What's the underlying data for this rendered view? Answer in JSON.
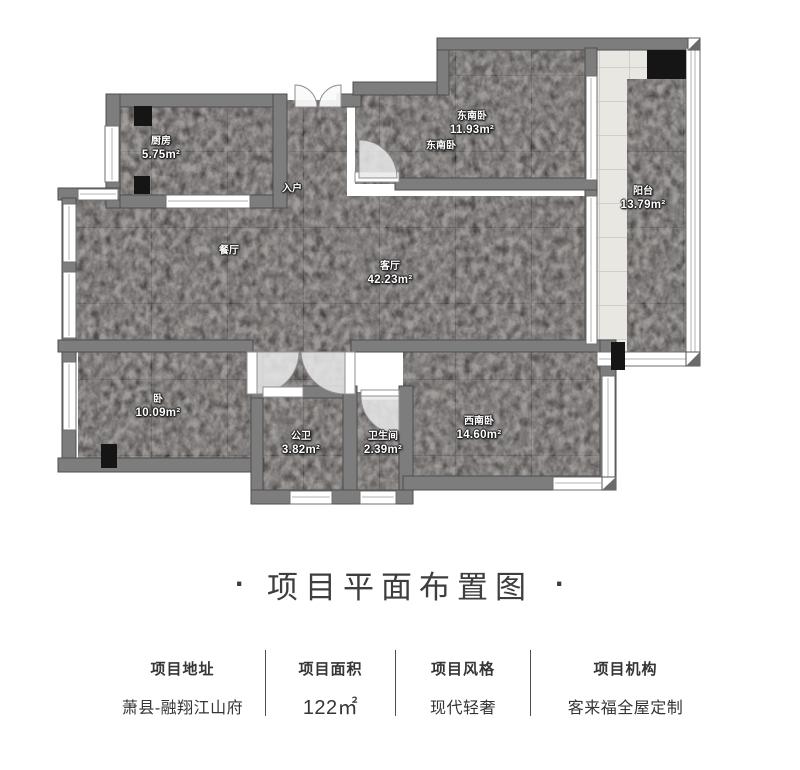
{
  "plan": {
    "rooms": [
      {
        "id": "kitchen",
        "name": "厨房",
        "area": "5.75m²"
      },
      {
        "id": "entry",
        "name": "入户",
        "area": ""
      },
      {
        "id": "southeast-bedroom",
        "name": "东南卧",
        "area": "11.93m²"
      },
      {
        "id": "southeast-bedroom-2",
        "name": "东南卧",
        "area": ""
      },
      {
        "id": "balcony",
        "name": "阳台",
        "area": "13.79m²"
      },
      {
        "id": "dining",
        "name": "餐厅",
        "area": ""
      },
      {
        "id": "living",
        "name": "客厅",
        "area": "42.23m²"
      },
      {
        "id": "bedroom",
        "name": "卧",
        "area": "10.09m²"
      },
      {
        "id": "public-bath",
        "name": "公卫",
        "area": "3.82m²"
      },
      {
        "id": "bathroom",
        "name": "卫生间",
        "area": "2.39m²"
      },
      {
        "id": "southwest-bedroom",
        "name": "西南卧",
        "area": "14.60m²"
      }
    ]
  },
  "title": {
    "dot": "·",
    "text": "项目平面布置图"
  },
  "info": [
    {
      "label": "项目地址",
      "value": "萧县-融翔江山府"
    },
    {
      "label": "项目面积",
      "value": "122㎡"
    },
    {
      "label": "项目风格",
      "value": "现代轻奢"
    },
    {
      "label": "项目机构",
      "value": "客来福全屋定制"
    }
  ],
  "colors": {
    "wall": "#7d7d7d",
    "floor_dark": "#4e4b4a",
    "floor_light": "#e9e7e2",
    "text_dark": "#3e3e3e",
    "black_fixture": "#151515"
  }
}
